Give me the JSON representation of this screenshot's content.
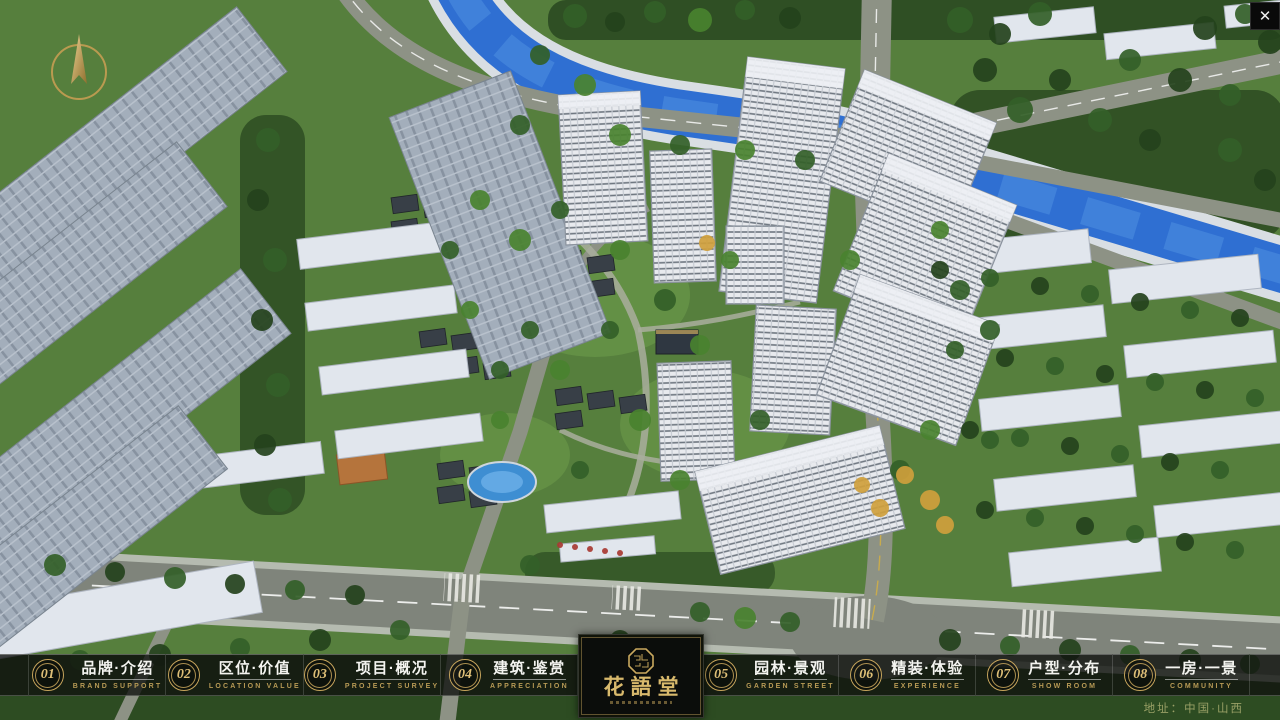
{
  "viewer": {
    "close_icon": "✕",
    "address": "地址：中国·山西"
  },
  "logo": {
    "title": "花語堂"
  },
  "nav": {
    "items": [
      {
        "num": "01",
        "label": "品牌·介绍",
        "sub": "BRAND SUPPORT"
      },
      {
        "num": "02",
        "label": "区位·价值",
        "sub": "LOCATION VALUE"
      },
      {
        "num": "03",
        "label": "项目·概况",
        "sub": "PROJECT SURVEY"
      },
      {
        "num": "04",
        "label": "建筑·鉴赏",
        "sub": "APPRECIATION"
      },
      {
        "num": "05",
        "label": "园林·景观",
        "sub": "GARDEN STREET"
      },
      {
        "num": "06",
        "label": "精装·体验",
        "sub": "EXPERIENCE"
      },
      {
        "num": "07",
        "label": "户型·分布",
        "sub": "SHOW ROOM"
      },
      {
        "num": "08",
        "label": "一房·一景",
        "sub": "COMMUNITY"
      }
    ]
  },
  "colors": {
    "accent_gold": "#c9a85e",
    "navbar_bg": "rgba(16,19,15,0.8)",
    "water_blue": "#2f6fd2"
  }
}
